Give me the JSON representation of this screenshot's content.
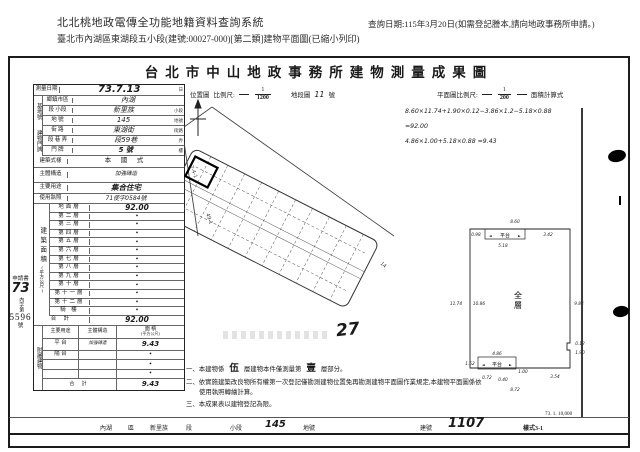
{
  "header": {
    "system_title": "北北桃地政電傳全功能地籍資料查詢系統",
    "query_date": "查詢日期:115年3月20日(如需登記謄本,請向地政事務所申請。)",
    "subtitle": "臺北市內湖區東湖段五小段(建號:00027-000)[第二類]建物平面圖(已縮小列印)"
  },
  "form": {
    "title": "台北市中山地政事務所建物測量成果圖",
    "survey": {
      "label": "測量日期",
      "value": "73.7.13",
      "suffix": "日"
    },
    "loc_map": {
      "label": "位置圖",
      "scale_label": "比例尺:",
      "num": "1",
      "den": "1200",
      "sheet_label": "地段圖",
      "sheet_value": "11",
      "sheet_suffix": "號"
    },
    "plan_scale": {
      "label": "平面圖比例尺:",
      "num": "1",
      "den": "200",
      "formula_label": "面積計算式"
    },
    "formulas": {
      "line1": "8.60×11.74+1.90×0.12−3.86×1.2−5.18×0.88",
      "line2": "=92.00",
      "line3": "4.86×1.00+5.18×0.88 =9.43"
    },
    "site": {
      "group1": "基地號",
      "group2": "建物門牌",
      "rows": [
        {
          "label": "鄉鎮市區",
          "value": "內湖",
          "suffix": ""
        },
        {
          "label": "段 小段",
          "value": "新里族",
          "suffix": "小段"
        },
        {
          "label": "地 號",
          "value": "145",
          "suffix": "地號"
        },
        {
          "label": "街 路",
          "value": "東湖街",
          "suffix": "街路"
        },
        {
          "label": "段 巷 弄",
          "value": "段59巷",
          "suffix": "弄"
        },
        {
          "label": "門 牌",
          "value": "5 號",
          "suffix": "樓"
        }
      ]
    },
    "bldg": {
      "rows": [
        {
          "label": "建築式樣",
          "value": "本 國 式"
        },
        {
          "label": "主體構造",
          "value": "加強磚造"
        },
        {
          "label": "主要用途",
          "value": "集合住宅"
        },
        {
          "label": "使用執照",
          "value": "71使字0584號"
        }
      ]
    },
    "area": {
      "vlabel": "建築面積",
      "vunit": "(平方公尺)",
      "floors": [
        {
          "label": "地面層",
          "value": "92.00"
        },
        {
          "label": "第二層",
          "value": "•"
        },
        {
          "label": "第三層",
          "value": "•"
        },
        {
          "label": "第四層",
          "value": "•"
        },
        {
          "label": "第五層",
          "value": "•"
        },
        {
          "label": "第六層",
          "value": "•"
        },
        {
          "label": "第七層",
          "value": "•"
        },
        {
          "label": "第八層",
          "value": "•"
        },
        {
          "label": "第九層",
          "value": "•"
        },
        {
          "label": "第十層",
          "value": "•"
        },
        {
          "label": "第十一層",
          "value": "•"
        },
        {
          "label": "第十二層",
          "value": "•"
        },
        {
          "label": "騎 樓",
          "value": "•"
        }
      ],
      "total_label": "合  計",
      "total": "92.00"
    },
    "annex": {
      "vlabel": "附屬建物",
      "h_use": "主要用途",
      "h_struct": "主體構造",
      "h_area1": "面 積",
      "h_area2": "(平方公尺)",
      "rows": [
        {
          "use": "平 台",
          "struct": "加強磚造",
          "area": "9.43"
        },
        {
          "use": "陽 台",
          "struct": "",
          "area": "•"
        },
        {
          "use": "",
          "struct": "",
          "area": "•"
        },
        {
          "use": "",
          "struct": "",
          "area": "•"
        }
      ],
      "total_label": "合  計",
      "total": "9.43"
    },
    "margin": {
      "l1": "申請書",
      "l2": "73",
      "l3": "內字第",
      "l4": "5596",
      "l5": "號"
    },
    "stamp_number": "27",
    "map": {
      "alley1": "7-4-1",
      "alley2": "49-1",
      "alley3": "14"
    },
    "plan": {
      "room": "全層",
      "plat_top": "平台",
      "plat_bottom": "平台",
      "dims": {
        "top": "8.60",
        "tl": "0.98",
        "plat_top_w": "5.18",
        "plat_top_r": "3.42",
        "left_outer": "11.74",
        "left_inner": "10.86",
        "right": "9.84",
        "n1": "0.12",
        "n2": "1.90",
        "br": "3.54",
        "pb_top": "4.86",
        "pb_left": "1.52",
        "pb_s1": "0.72",
        "pb_s2": "0.40",
        "pb_r": "1.00",
        "bottom": "8.72"
      }
    },
    "notes": {
      "n1a": "一、本建物係",
      "n1b": "伍",
      "n1c": "層建物本件僅測量第",
      "n1d": "壹",
      "n1e": "層部分。",
      "n2": "二、依實施建築改良物所有權第一次登記僅勘測建物位置免再勘測建物平面圖作業規定,本建物平面圖係依使用執照轉繪計算。",
      "n3": "三、本成果表以建物登記為限。"
    },
    "strip": {
      "district": "內湖",
      "district_s": "區",
      "section": "新里族",
      "section_s": "段",
      "sub_s": "小段",
      "parcel": "145",
      "parcel_s": "地號",
      "bld_s": "建號",
      "bld": "1107",
      "code": "樣式3-1",
      "print": "73. 1. 10,000"
    }
  }
}
